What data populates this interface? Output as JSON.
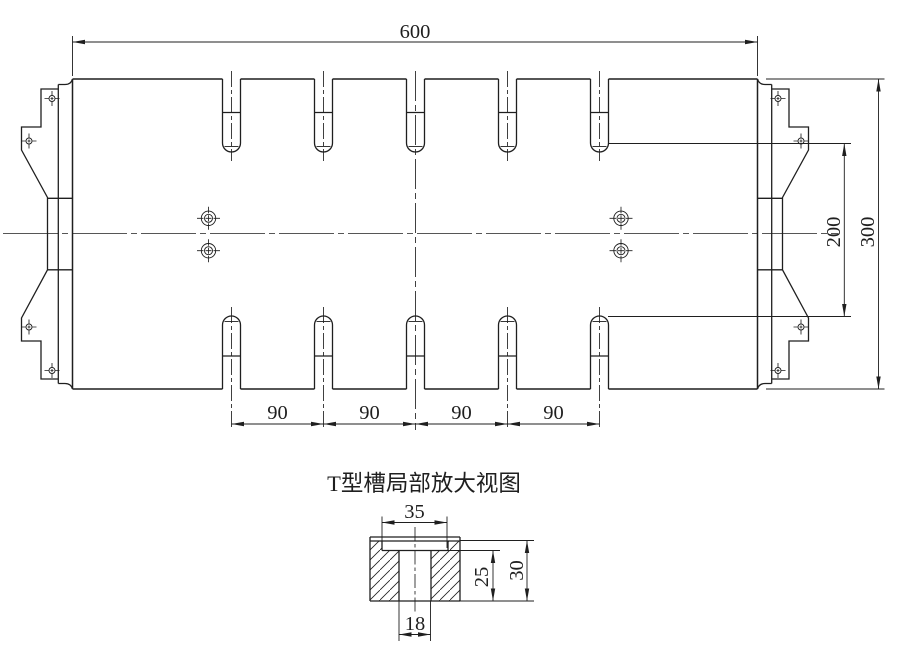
{
  "main_view": {
    "dim_overall_width": "600",
    "dim_overall_height": "300",
    "dim_slot_end_distance": "200",
    "dim_slot_pitches": [
      "90",
      "90",
      "90",
      "90"
    ]
  },
  "detail_view": {
    "title": "T型槽局部放大视图",
    "dim_slot_top_width": "35",
    "dim_total_depth": "30",
    "dim_neck_depth": "25",
    "dim_neck_width": "18"
  },
  "style": {
    "line_color": "#1f1f1f",
    "background": "#ffffff"
  }
}
